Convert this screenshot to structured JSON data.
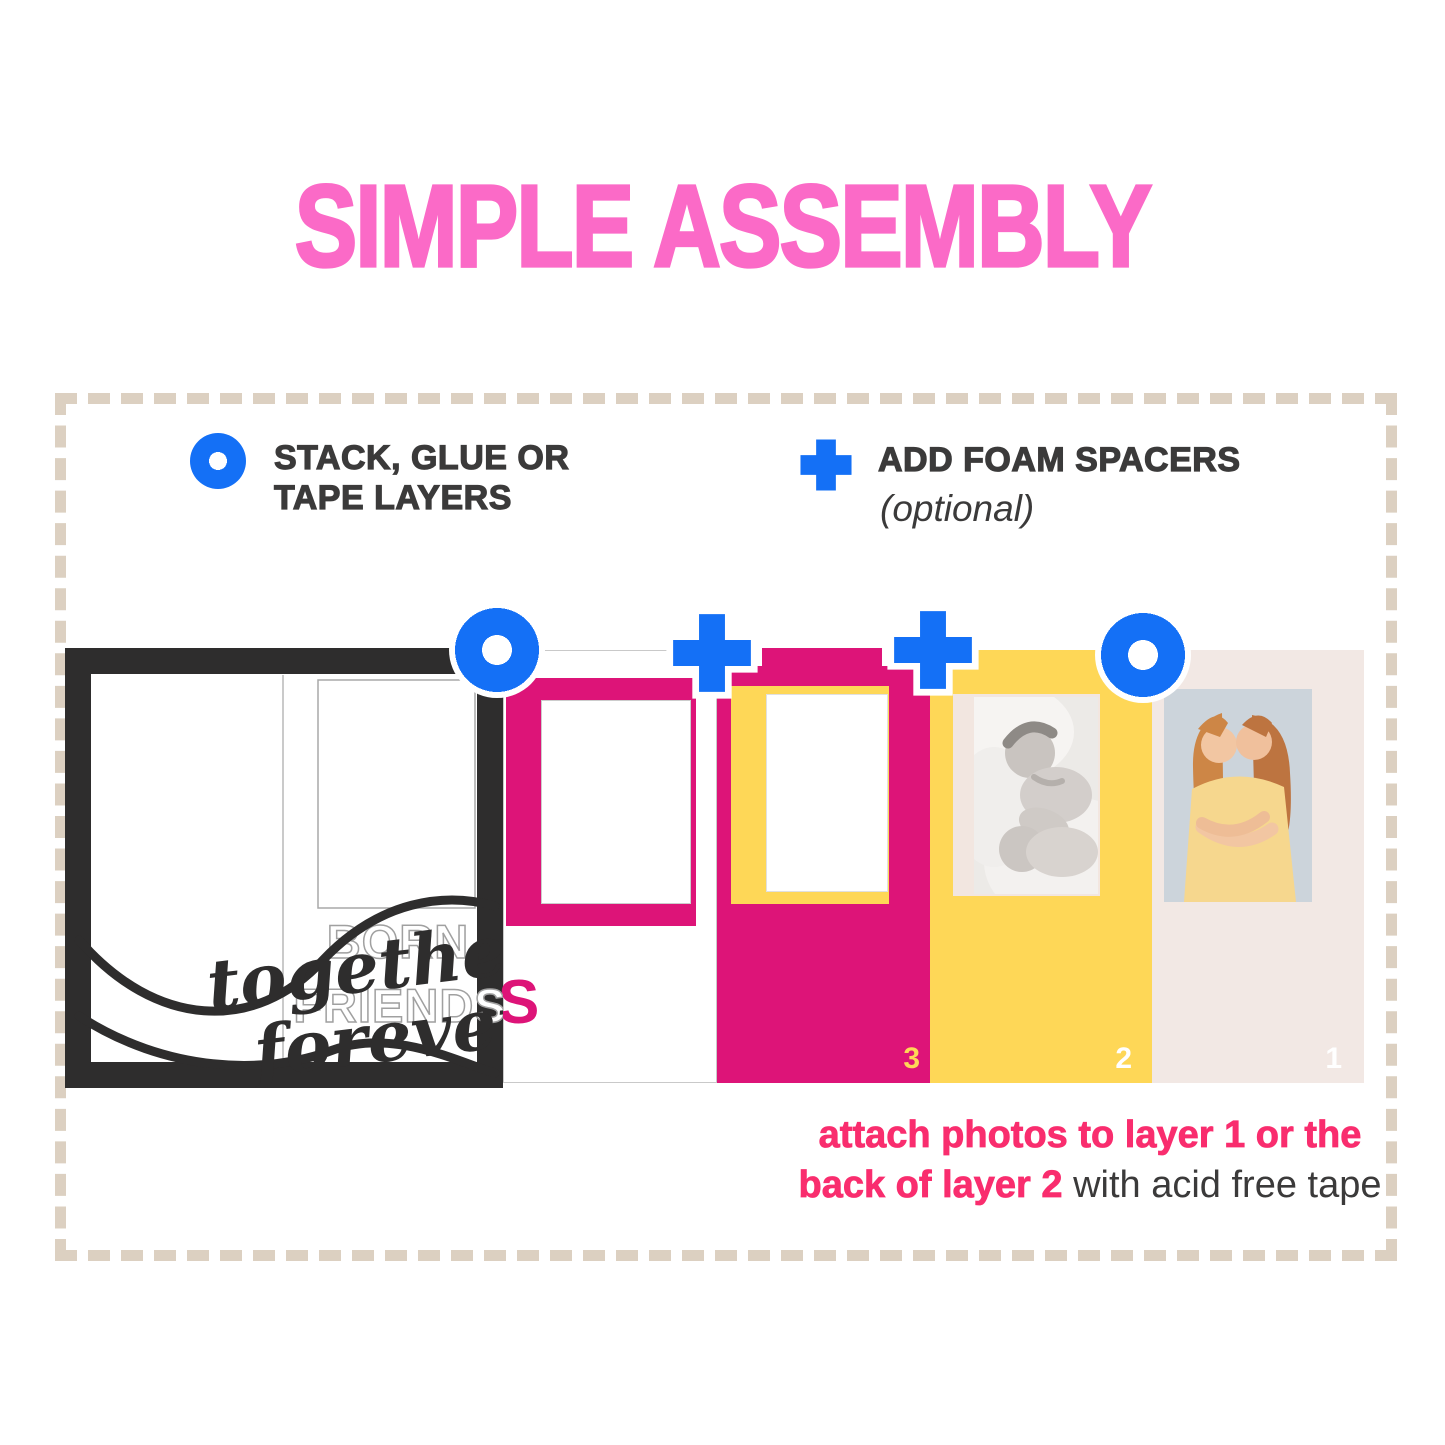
{
  "title": "SIMPLE ASSEMBLY",
  "legend": {
    "stack_line1": "STACK, GLUE OR",
    "stack_line2": "TAPE LAYERS",
    "foam_label": "ADD FOAM SPACERS",
    "foam_sublabel": "(optional)"
  },
  "diagram": {
    "script_line1": "together",
    "script_line2": "forever",
    "outline_word1": "BORN",
    "outline_word2": "FRIENDS",
    "hidden_letter": "S",
    "numbers": {
      "n3": "3",
      "n2": "2",
      "n1": "1"
    }
  },
  "caption": {
    "line1": "attach photos to layer 1 or the",
    "line2_bold": "back of layer 2",
    "line2_rest": " with acid free tape"
  },
  "icons": {
    "stack_icon": "blue-ring-circle",
    "spacer_icon": "blue-plus"
  },
  "colors": {
    "title_pink": "#fb6ac7",
    "magenta": "#dd1478",
    "yellow": "#fed757",
    "cream": "#f2e8e4",
    "blue": "#1470f6",
    "caption_pink": "#f92d6e",
    "text_dark": "#3b3a3a",
    "dash_beige": "#dcd0c1",
    "frame_black": "#2e2d2d"
  }
}
